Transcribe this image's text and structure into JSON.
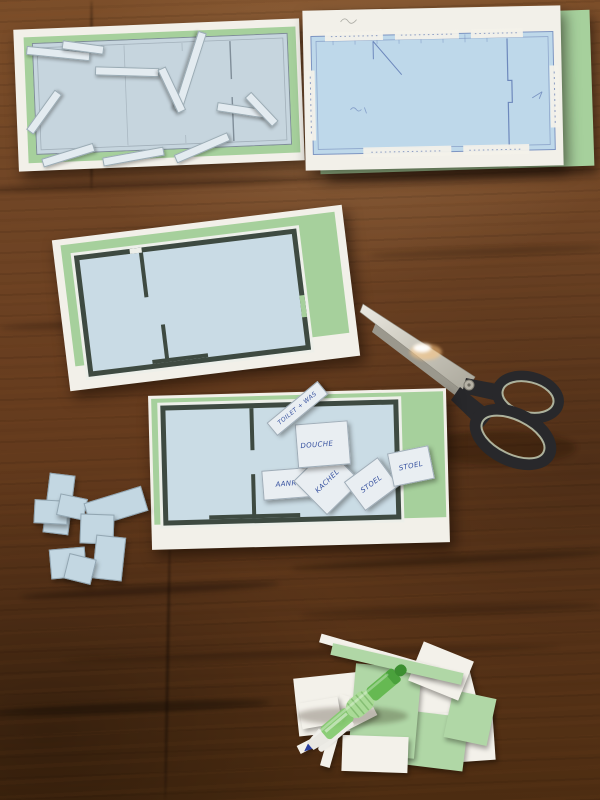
{
  "scene": {
    "setting": "top-down photo of a dark brown wooden table used for a paper floor-plan craft exercise",
    "objects": [
      {
        "name": "floorplan-sheet-top-left",
        "description": "printed light-blue floor plan on green card with loose thin paper strips scattered on it"
      },
      {
        "name": "floorplan-sheet-top-right",
        "description": "hand-annotated light-blue floor plan in blue ink with white measurement strips along the edges"
      },
      {
        "name": "floorplan-sheet-middle",
        "description": "floor plan with thick dark walls on a green card, tilted"
      },
      {
        "name": "floorplan-sheet-bottom",
        "description": "floor plan with thick dark walls covered with small handwritten room/furniture labels"
      },
      {
        "name": "scissors",
        "description": "scissors with silver blades and black handles, pointing up-left"
      },
      {
        "name": "pen",
        "description": "green ballpoint pen lying on a pile of green and white paper scraps"
      },
      {
        "name": "paper-scrap-pile-blue",
        "count": 8
      },
      {
        "name": "paper-scrap-pile-green-white",
        "count": 13
      }
    ]
  },
  "labels": {
    "toilet_was": "TOILET + WAS",
    "douche": "DOUCHE",
    "aanrecht": "AANRECHT",
    "kachel": "KACHEL",
    "stoel_1": "STOEL",
    "stoel_2": "STOEL"
  },
  "colors": {
    "table_wood": "#63391c",
    "paper_white": "#f2f0e9",
    "card_green": "#a6d09c",
    "plan_blue": "#cadce5",
    "wall_dark": "#3e4a41",
    "ink_blue": "#35509f",
    "scissor_handle": "#28282b",
    "pen_green": "#66b952"
  }
}
